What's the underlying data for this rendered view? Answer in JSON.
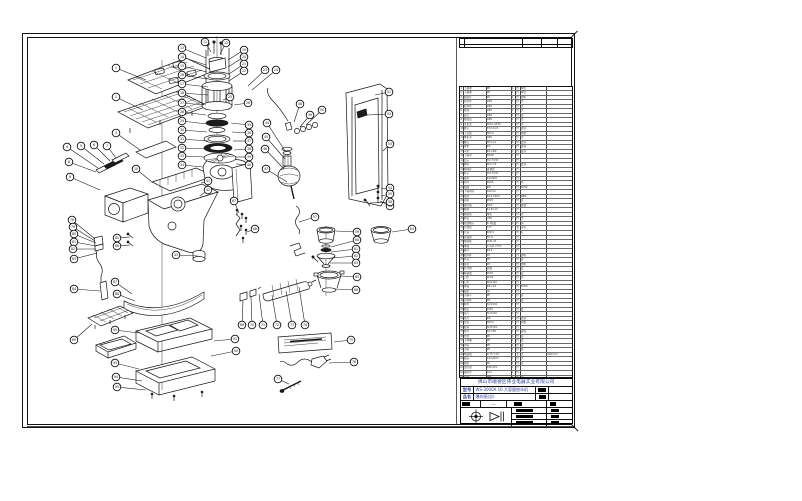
{
  "sheet": {
    "title_block": {
      "company": "佛山市顺德区伟业电器实业有限公司",
      "model_label": "型号",
      "model_value": "WS-3000A 16 大容量刨冰机",
      "name_label": "品名",
      "name_value": "爆炸图(总)",
      "scale_value": "—"
    }
  },
  "bom": {
    "rows": [
      [
        "1",
        "上格栅",
        "PP",
        "1",
        "件",
        "本色",
        ""
      ],
      [
        "2",
        "下格栅",
        "PP",
        "1",
        "件",
        "本色",
        ""
      ],
      [
        "3",
        "视窗片",
        "PC",
        "1",
        "件",
        "透明",
        ""
      ],
      [
        "4",
        "左饰条",
        "ABS",
        "1",
        "件",
        "黑",
        ""
      ],
      [
        "5",
        "右饰条",
        "ABS",
        "1",
        "件",
        "黑",
        ""
      ],
      [
        "6",
        "按键",
        "ABS",
        "2",
        "件",
        "黑",
        ""
      ],
      [
        "7",
        "面壳",
        "ABS",
        "1",
        "件",
        "白",
        ""
      ],
      [
        "8",
        "视窗盒",
        "ABS",
        "1",
        "件",
        "黑",
        ""
      ],
      [
        "9",
        "主机架",
        "PA6+GF30",
        "1",
        "件",
        "黑",
        ""
      ],
      [
        "10",
        "螺钉",
        "ST2.9×8",
        "6",
        "件",
        "镀锌",
        ""
      ],
      [
        "11",
        "上盖板",
        "SPCC",
        "1",
        "件",
        "喷粉",
        ""
      ],
      [
        "12",
        "电机罩",
        "ABS",
        "1",
        "件",
        "黑",
        ""
      ],
      [
        "13",
        "螺钉",
        "M4×12",
        "4",
        "件",
        "镀锌",
        ""
      ],
      [
        "14",
        "弹垫",
        "Φ4",
        "4",
        "件",
        "镀锌",
        ""
      ],
      [
        "15",
        "平垫",
        "Φ4×Φ9",
        "4",
        "件",
        "镀锌",
        ""
      ],
      [
        "16",
        "上轴承",
        "608Z",
        "1",
        "件",
        "",
        ""
      ],
      [
        "17",
        "定子",
        "HU-7030",
        "1",
        "件",
        "",
        ""
      ],
      [
        "18",
        "螺栓",
        "M4×70",
        "2",
        "件",
        "镀锌",
        ""
      ],
      [
        "19",
        "绝缘片",
        "青稞纸",
        "2",
        "件",
        "",
        ""
      ],
      [
        "20",
        "转子",
        "HU-7030",
        "1",
        "件",
        "",
        ""
      ],
      [
        "21",
        "轴承",
        "6200ZZ",
        "1",
        "件",
        "",
        ""
      ],
      [
        "22",
        "风叶",
        "PA66",
        "1",
        "件",
        "黑",
        ""
      ],
      [
        "23",
        "挡圈",
        "Φ8",
        "1",
        "件",
        "65Mn",
        ""
      ],
      [
        "24",
        "下轴承座",
        "ADC12",
        "1",
        "件",
        "",
        ""
      ],
      [
        "25",
        "油封",
        "Φ12×Φ22",
        "1",
        "件",
        "NBR",
        ""
      ],
      [
        "26",
        "齿轮",
        "POM",
        "1",
        "件",
        "白",
        ""
      ],
      [
        "27",
        "输出轴",
        "45#",
        "1",
        "件",
        "镀铬",
        ""
      ],
      [
        "28",
        "碳刷",
        "6×8×15",
        "2",
        "件",
        "",
        ""
      ],
      [
        "29",
        "碳刷架",
        "电木",
        "2",
        "件",
        "黑",
        ""
      ],
      [
        "30",
        "刷盖",
        "ABS",
        "2",
        "件",
        "黑",
        ""
      ],
      [
        "31",
        "接线端子",
        "6.3插簧",
        "6",
        "件",
        "铜",
        ""
      ],
      [
        "32",
        "导线组",
        "0.5²",
        "1",
        "套",
        "多色",
        ""
      ],
      [
        "33",
        "开关",
        "KCD4",
        "1",
        "件",
        "红",
        ""
      ],
      [
        "34",
        "调速器",
        "FD-9",
        "1",
        "件",
        "",
        ""
      ],
      [
        "35",
        "线路板",
        "PCB-V2",
        "1",
        "件",
        "",
        ""
      ],
      [
        "36",
        "电容",
        "0.1μF 275V",
        "1",
        "件",
        "",
        ""
      ],
      [
        "37",
        "磁环",
        "Φ18",
        "2",
        "件",
        "",
        ""
      ],
      [
        "38",
        "搅拌杯",
        "PC",
        "1",
        "件",
        "透明",
        ""
      ],
      [
        "39",
        "杯盖",
        "PP",
        "1",
        "件",
        "白",
        ""
      ],
      [
        "40",
        "量杯",
        "PC",
        "1",
        "件",
        "透明",
        ""
      ],
      [
        "41",
        "密封圈",
        "硅胶",
        "1",
        "件",
        "白",
        ""
      ],
      [
        "42",
        "联轴器",
        "POM",
        "1",
        "件",
        "白",
        ""
      ],
      [
        "43",
        "刀座",
        "PA66",
        "1",
        "件",
        "黑",
        ""
      ],
      [
        "44",
        "刀片",
        "SUS420",
        "2",
        "件",
        "",
        ""
      ],
      [
        "45",
        "弹簧",
        "Φ6×20",
        "1",
        "件",
        "65Mn",
        ""
      ],
      [
        "46",
        "轴套",
        "铜",
        "1",
        "件",
        "",
        ""
      ],
      [
        "47",
        "小漏斗",
        "PP",
        "1",
        "件",
        "白",
        ""
      ],
      [
        "48",
        "压料杯",
        "PP",
        "1",
        "件",
        "白",
        ""
      ],
      [
        "49",
        "料筒",
        "SUS304",
        "1",
        "件",
        "",
        ""
      ],
      [
        "50",
        "端盖",
        "POM",
        "1",
        "件",
        "白",
        ""
      ],
      [
        "51",
        "滚刀",
        "SUS420",
        "1",
        "件",
        "",
        ""
      ],
      [
        "52",
        "垫片",
        "Φ6",
        "2",
        "件",
        "镀锌",
        ""
      ],
      [
        "53",
        "支架",
        "SPCC",
        "1",
        "件",
        "喷粉",
        ""
      ],
      [
        "54",
        "挂钩",
        "SUS304",
        "1",
        "件",
        "",
        ""
      ],
      [
        "55",
        "拉杆",
        "Φ3×80",
        "1",
        "件",
        "镀锌",
        ""
      ],
      [
        "56",
        "弯管",
        "PP",
        "1",
        "件",
        "白",
        ""
      ],
      [
        "57",
        "下料嘴",
        "PP",
        "1",
        "件",
        "白",
        ""
      ],
      [
        "58",
        "大碗",
        "PP",
        "1",
        "件",
        "白",
        ""
      ],
      [
        "59",
        "小碗",
        "PP",
        "1",
        "件",
        "白",
        ""
      ],
      [
        "60",
        "电源线",
        "0.75²×3C",
        "1",
        "条",
        "黑",
        "H05VV-F"
      ],
      [
        "61",
        "插头",
        "16A250V",
        "1",
        "件",
        "黑",
        ""
      ],
      [
        "62",
        "线扣",
        "PA",
        "1",
        "件",
        "黑",
        ""
      ],
      [
        "63",
        "温控器",
        "KSD301",
        "1",
        "件",
        "",
        ""
      ],
      [
        "64",
        "保险丝",
        "10A",
        "1",
        "件",
        "",
        ""
      ],
      [
        "65",
        "铭牌",
        "PET",
        "1",
        "件",
        "银",
        ""
      ],
      [
        "66",
        "标贴",
        "PET",
        "1",
        "件",
        "",
        ""
      ],
      [
        "67",
        "说明书",
        "105g铜版",
        "1",
        "本",
        "",
        ""
      ],
      [
        "68",
        "侧板",
        "SPCC",
        "1",
        "件",
        "喷粉",
        ""
      ],
      [
        "69",
        "装饰贴",
        "PET",
        "1",
        "件",
        "银",
        ""
      ],
      [
        "70",
        "中框",
        "PP",
        "1",
        "件",
        "黑",
        ""
      ],
      [
        "71",
        "底盘",
        "PP",
        "1",
        "件",
        "黑",
        ""
      ],
      [
        "72",
        "接水盘",
        "PP",
        "1",
        "件",
        "白",
        ""
      ],
      [
        "73",
        "小托盘",
        "PP",
        "1",
        "件",
        "白",
        ""
      ],
      [
        "74",
        "防滑垫",
        "橡胶",
        "4",
        "件",
        "黑",
        ""
      ],
      [
        "75",
        "底框",
        "PP",
        "1",
        "件",
        "黑",
        ""
      ],
      [
        "76",
        "脚垫",
        "橡胶",
        "4",
        "件",
        "黑",
        ""
      ],
      [
        "77",
        "螺钉",
        "ST3.9×13",
        "8",
        "件",
        "镀锌",
        ""
      ],
      [
        "78",
        "螺钉",
        "M4×8",
        "6",
        "件",
        "镀锌",
        ""
      ],
      [
        "79",
        "螺母",
        "M4",
        "4",
        "件",
        "镀锌",
        ""
      ],
      [
        "80",
        "搭扣",
        "SPCC",
        "2",
        "件",
        "镀锌",
        ""
      ],
      [
        "81",
        "合页",
        "SUS304",
        "2",
        "件",
        "",
        ""
      ],
      [
        "82",
        "护罩",
        "ABS",
        "1",
        "件",
        "黑",
        ""
      ],
      [
        "83",
        "包装箱",
        "K=K瓦楞",
        "1",
        "个",
        "",
        ""
      ]
    ]
  },
  "diagram": {
    "balloons": [
      [
        "1",
        116,
        68,
        146,
        80
      ],
      [
        "2",
        116,
        97,
        143,
        110
      ],
      [
        "3",
        116,
        133,
        140,
        150
      ],
      [
        "4",
        67,
        147,
        98,
        168
      ],
      [
        "5",
        81,
        146,
        104,
        164
      ],
      [
        "6",
        94,
        145,
        110,
        161
      ],
      [
        "7",
        107,
        146,
        116,
        158
      ],
      [
        "8",
        69,
        162,
        96,
        172
      ],
      [
        "9",
        70,
        177,
        100,
        190
      ],
      [
        "10",
        136,
        169,
        152,
        182
      ],
      [
        "11",
        205,
        42,
        211,
        52
      ],
      [
        "12",
        226,
        43,
        220,
        54
      ],
      [
        "13",
        182,
        48,
        206,
        58
      ],
      [
        "14",
        182,
        57,
        206,
        65
      ],
      [
        "15",
        182,
        66,
        207,
        72
      ],
      [
        "16",
        182,
        75,
        207,
        79
      ],
      [
        "17",
        182,
        84,
        208,
        87
      ],
      [
        "18",
        182,
        93,
        208,
        95
      ],
      [
        "19",
        244,
        50,
        228,
        60
      ],
      [
        "20",
        244,
        57,
        228,
        67
      ],
      [
        "21",
        244,
        64,
        229,
        74
      ],
      [
        "22",
        244,
        71,
        229,
        81
      ],
      [
        "23",
        265,
        70,
        248,
        86
      ],
      [
        "24",
        276,
        70,
        252,
        90
      ],
      [
        "25",
        230,
        97,
        223,
        100
      ],
      [
        "26",
        248,
        103,
        234,
        105
      ],
      [
        "27",
        182,
        103,
        206,
        105
      ],
      [
        "28",
        182,
        112,
        206,
        115
      ],
      [
        "29",
        182,
        121,
        207,
        124
      ],
      [
        "30",
        182,
        130,
        207,
        132
      ],
      [
        "31",
        182,
        139,
        208,
        141
      ],
      [
        "32",
        182,
        148,
        208,
        149
      ],
      [
        "33",
        182,
        156,
        205,
        157
      ],
      [
        "34",
        182,
        165,
        203,
        167
      ],
      [
        "35",
        249,
        125,
        231,
        123
      ],
      [
        "36",
        249,
        133,
        232,
        132
      ],
      [
        "37",
        249,
        141,
        233,
        141
      ],
      [
        "38",
        249,
        149,
        234,
        150
      ],
      [
        "39",
        249,
        157,
        235,
        157
      ],
      [
        "40",
        249,
        165,
        236,
        164
      ],
      [
        "41",
        208,
        181,
        201,
        183
      ],
      [
        "42",
        208,
        190,
        200,
        196
      ],
      [
        "43",
        176,
        255,
        198,
        256
      ],
      [
        "44",
        267,
        123,
        285,
        151
      ],
      [
        "45",
        266,
        137,
        285,
        159
      ],
      [
        "46",
        265,
        149,
        284,
        169
      ],
      [
        "47",
        266,
        169,
        287,
        182
      ],
      [
        "48",
        300,
        104,
        294,
        122
      ],
      [
        "49",
        310,
        115,
        300,
        127
      ],
      [
        "50",
        322,
        110,
        306,
        125
      ],
      [
        "51",
        389,
        92,
        375,
        95
      ],
      [
        "52",
        389,
        114,
        367,
        115
      ],
      [
        "53",
        390,
        144,
        383,
        151
      ],
      [
        "54",
        390,
        188,
        381,
        189
      ],
      [
        "55",
        390,
        194,
        381,
        196
      ],
      [
        "56",
        390,
        206,
        380,
        201
      ],
      [
        "57",
        315,
        217,
        299,
        222
      ],
      [
        "58",
        390,
        202,
        370,
        203
      ],
      [
        "59",
        357,
        232,
        336,
        231
      ],
      [
        "60",
        357,
        240,
        331,
        247
      ],
      [
        "61",
        356,
        249,
        331,
        252
      ],
      [
        "62",
        356,
        256,
        332,
        258
      ],
      [
        "63",
        356,
        263,
        330,
        263
      ],
      [
        "64",
        412,
        229,
        392,
        232
      ],
      [
        "65",
        357,
        277,
        341,
        276
      ],
      [
        "66",
        356,
        290,
        335,
        289
      ],
      [
        "67",
        234,
        201,
        239,
        213
      ],
      [
        "68",
        255,
        229,
        247,
        232
      ],
      [
        "69",
        242,
        325,
        243,
        301
      ],
      [
        "70",
        252,
        325,
        251,
        297
      ],
      [
        "71",
        263,
        325,
        259,
        294
      ],
      [
        "72",
        277,
        325,
        272,
        295
      ],
      [
        "73",
        292,
        325,
        286,
        291
      ],
      [
        "74",
        305,
        325,
        299,
        287
      ],
      [
        "75",
        351,
        340,
        334,
        342
      ],
      [
        "76",
        354,
        362,
        329,
        363
      ],
      [
        "77",
        278,
        379,
        289,
        384
      ],
      [
        "78",
        72,
        220,
        95,
        239
      ],
      [
        "79",
        73,
        227,
        95,
        241
      ],
      [
        "80",
        74,
        234,
        96,
        243
      ],
      [
        "81",
        74,
        242,
        96,
        246
      ],
      [
        "82",
        73,
        249,
        96,
        249
      ],
      [
        "83",
        74,
        259,
        97,
        253
      ],
      [
        "84",
        74,
        289,
        100,
        291
      ],
      [
        "85",
        117,
        238,
        130,
        237
      ],
      [
        "86",
        117,
        246,
        130,
        245
      ],
      [
        "87",
        115,
        282,
        132,
        294
      ],
      [
        "88",
        117,
        294,
        135,
        301
      ],
      [
        "89",
        74,
        340,
        92,
        324
      ],
      [
        "90",
        115,
        330,
        139,
        333
      ],
      [
        "91",
        235,
        339,
        214,
        341
      ],
      [
        "92",
        236,
        351,
        211,
        356
      ],
      [
        "93",
        115,
        363,
        139,
        369
      ],
      [
        "94",
        116,
        377,
        142,
        381
      ],
      [
        "95",
        117,
        387,
        146,
        390
      ]
    ]
  }
}
